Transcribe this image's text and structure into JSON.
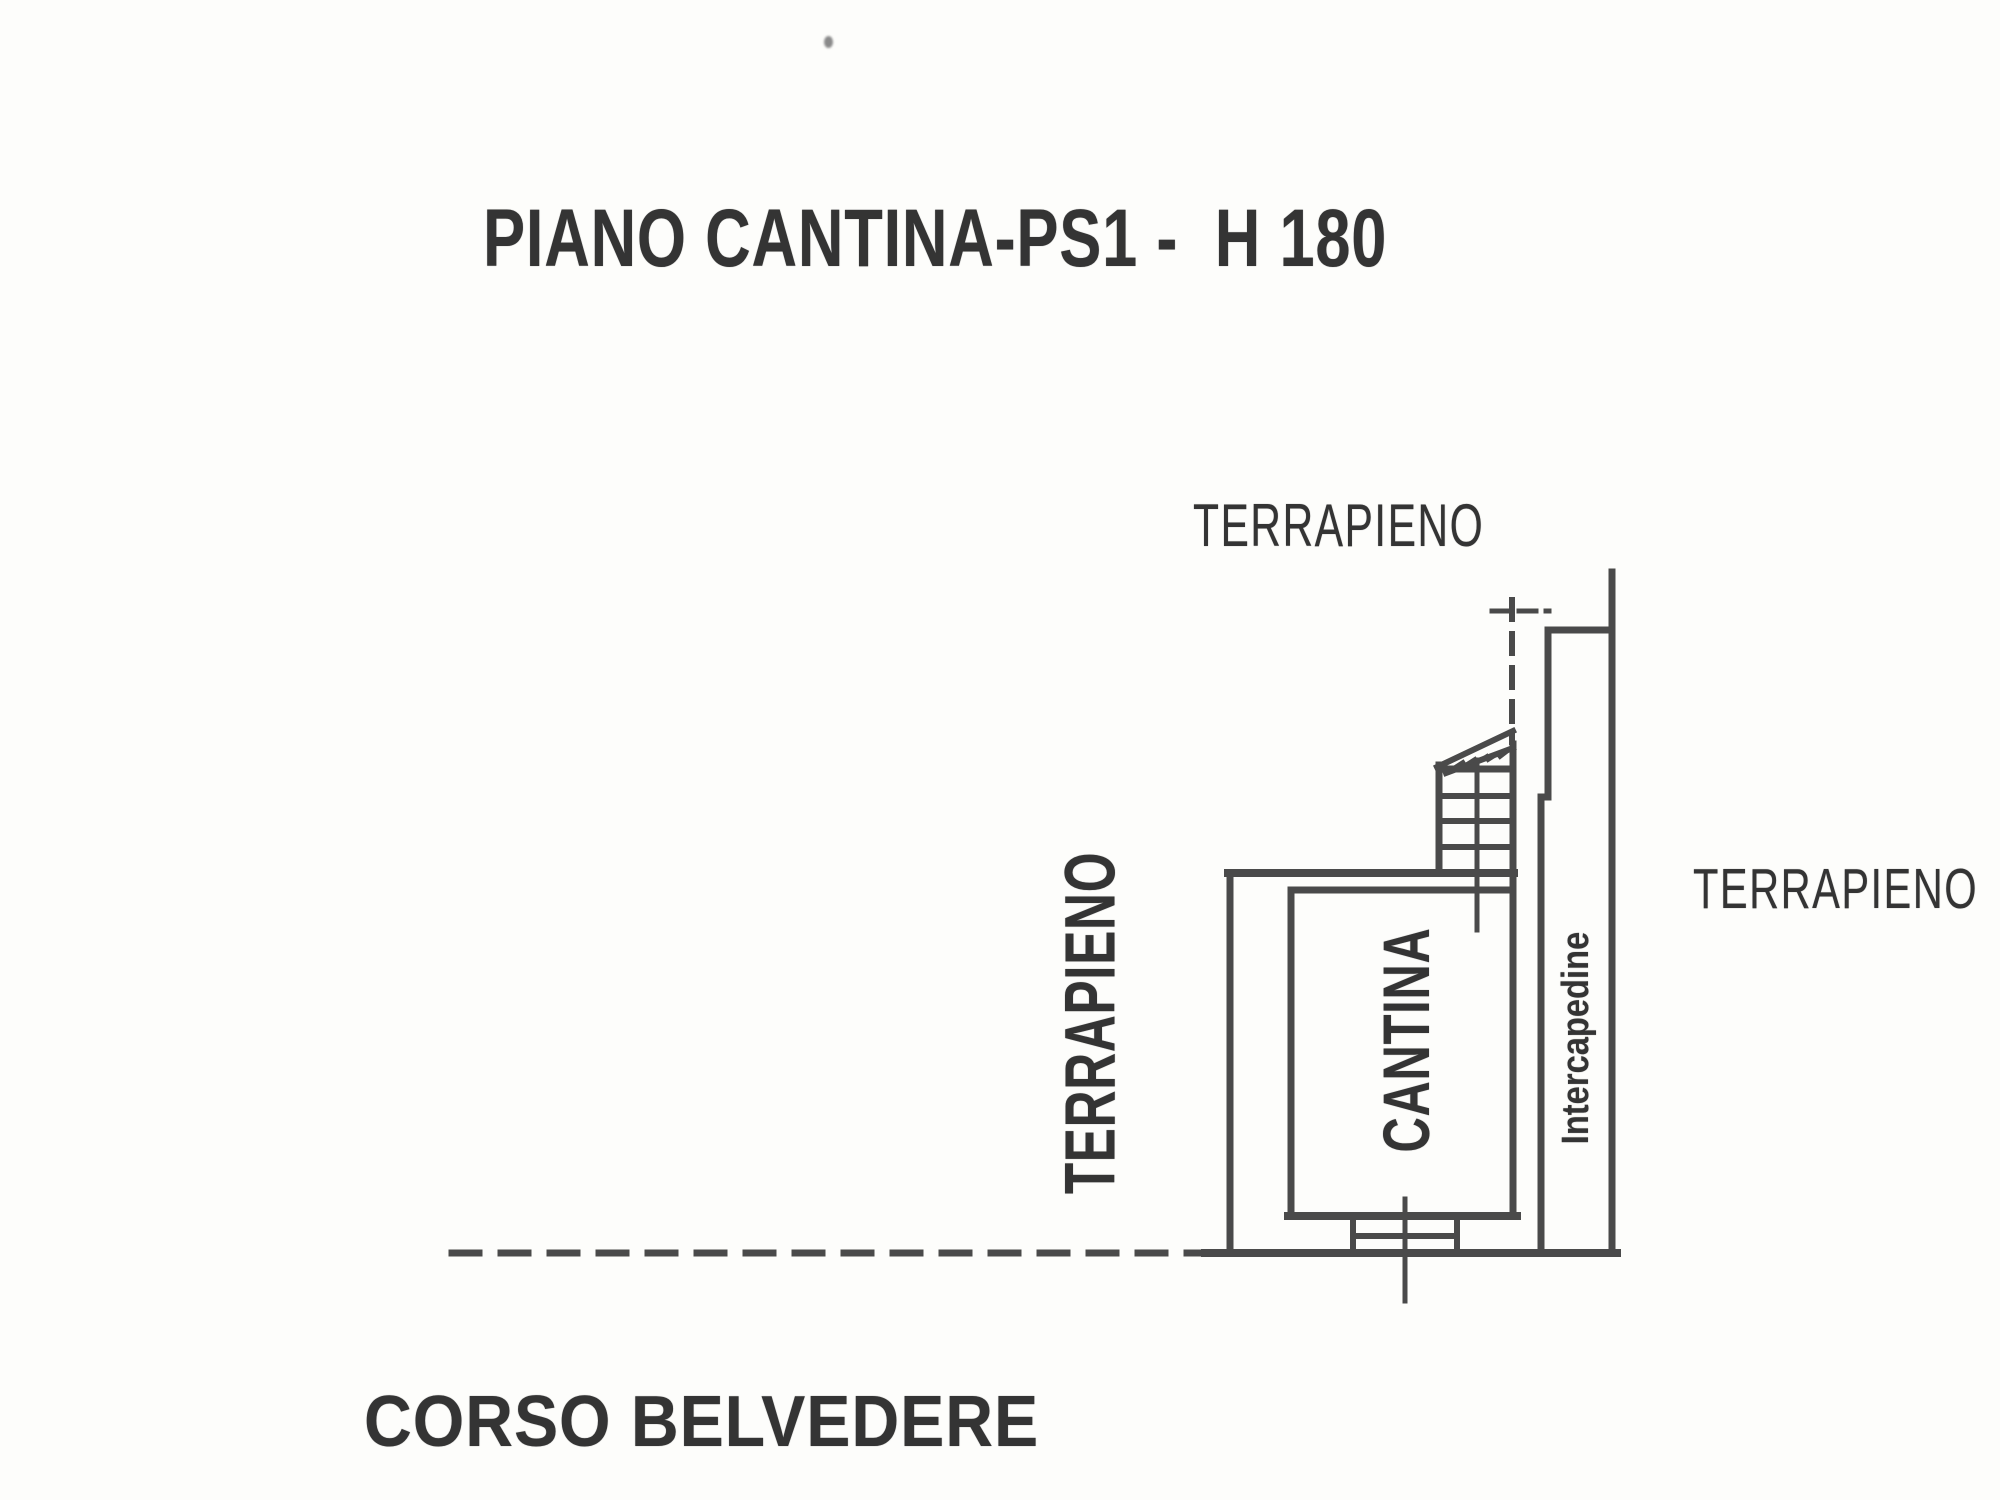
{
  "document": {
    "title": "PIANO CANTINA-PS1 -  H 180",
    "street": "CORSO BELVEDERE"
  },
  "labels": {
    "terrapieno_top": "TERRAPIENO",
    "terrapieno_left": "TERRAPIENO",
    "terrapieno_right": "TERRAPIENO",
    "room": "CANTINA",
    "cavity": "Intercapedine"
  },
  "style": {
    "ink_color": "#3d3d3d",
    "paper_color": "#fdfdfb"
  }
}
